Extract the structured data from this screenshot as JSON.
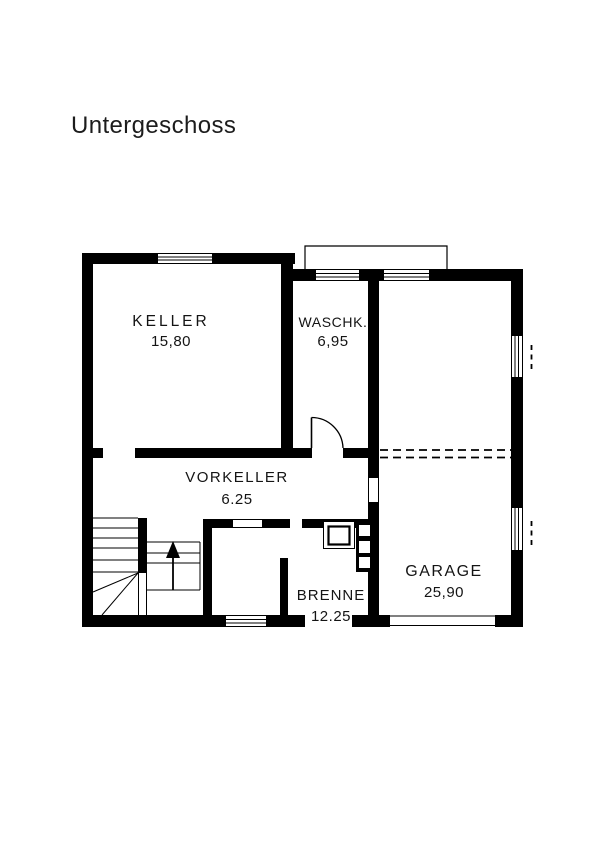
{
  "page": {
    "title": "Untergeschoss"
  },
  "floorplan": {
    "rooms": [
      {
        "id": "keller",
        "name": "KELLER",
        "area": "15,80"
      },
      {
        "id": "waschk",
        "name": "WASCHK.",
        "area": "6,95"
      },
      {
        "id": "vorkeller",
        "name": "VORKELLER",
        "area": "6.25"
      },
      {
        "id": "brenne",
        "name": "BRENNE",
        "area": "12.25"
      },
      {
        "id": "garage",
        "name": "GARAGE",
        "area": "25,90"
      }
    ]
  }
}
